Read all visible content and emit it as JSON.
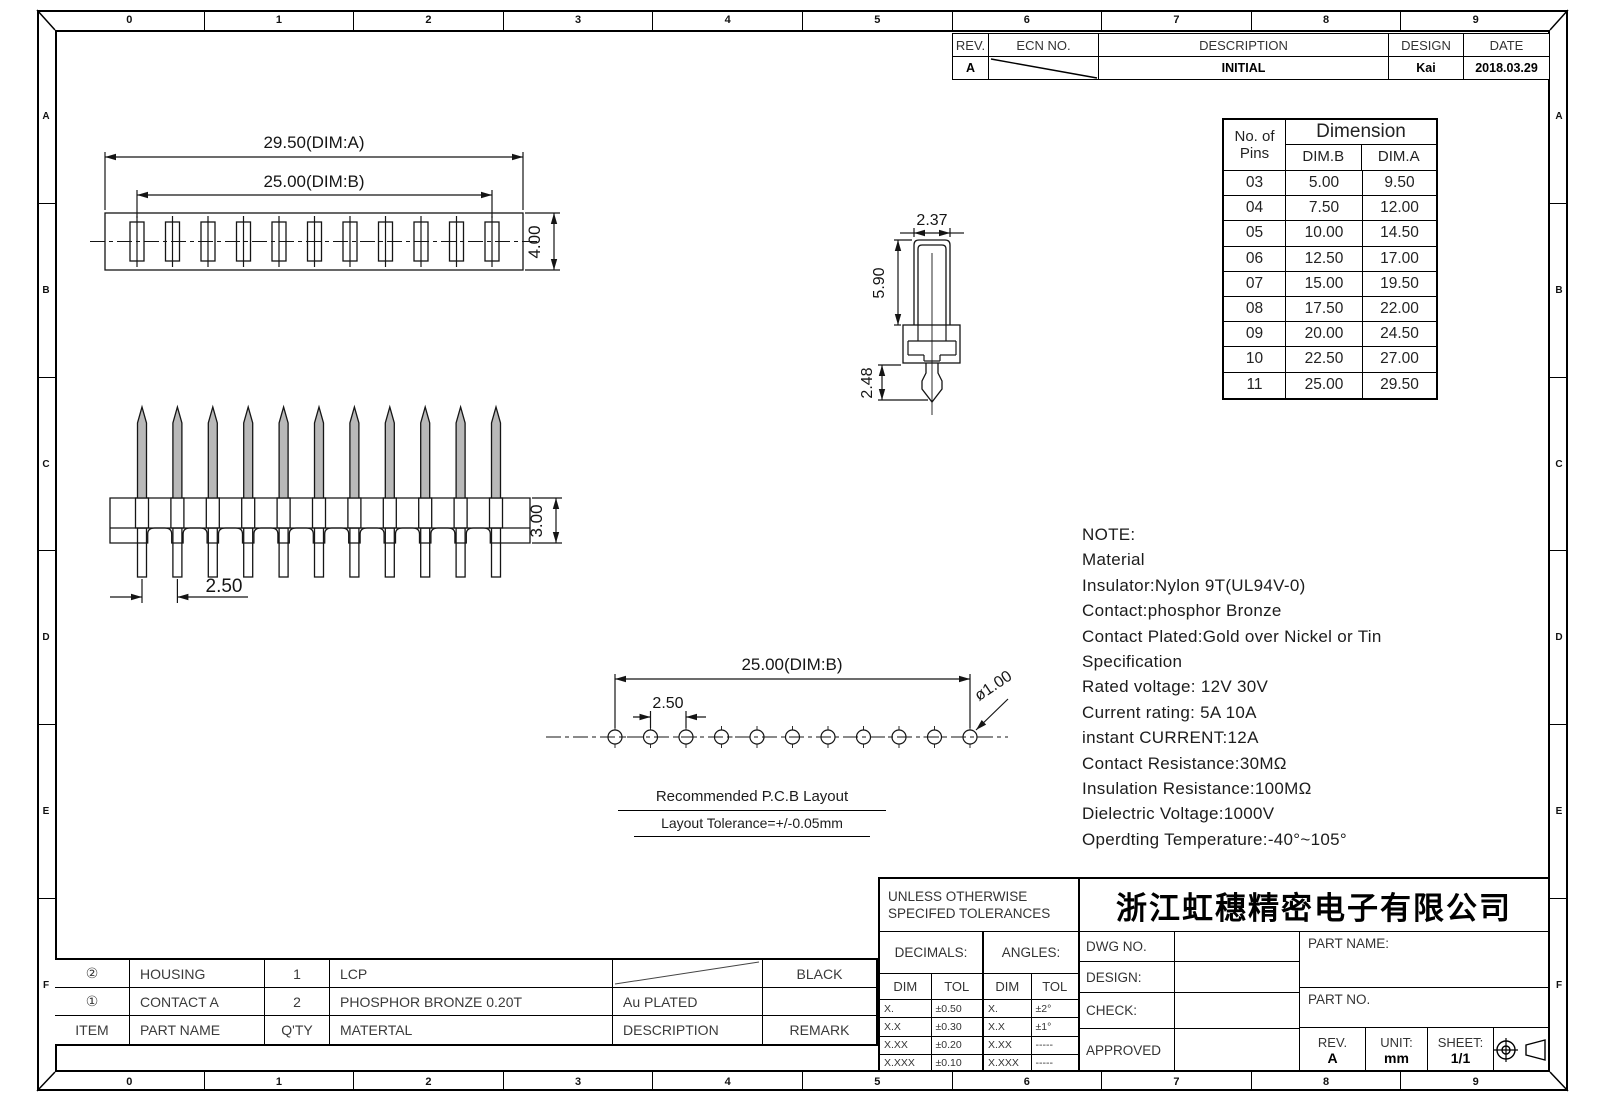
{
  "sheet": {
    "cols": [
      "0",
      "1",
      "2",
      "3",
      "4",
      "5",
      "6",
      "7",
      "8",
      "9"
    ],
    "rows": [
      "A",
      "B",
      "C",
      "D",
      "E",
      "F"
    ]
  },
  "revision_table": {
    "headers": {
      "rev": "REV.",
      "ecn": "ECN  NO.",
      "description": "DESCRIPTION",
      "design": "DESIGN",
      "date": "DATE"
    },
    "rows": [
      {
        "rev": "A",
        "ecn": "",
        "description": "INITIAL",
        "design": "Kai",
        "date": "2018.03.29"
      }
    ]
  },
  "dimension_table": {
    "col1_header_line1": "No.  of",
    "col1_header_line2": "Pins",
    "span_header": "Dimension",
    "dim_b_header": "DIM.B",
    "dim_a_header": "DIM.A",
    "rows": [
      {
        "pins": "03",
        "dim_b": "5.00",
        "dim_a": "9.50"
      },
      {
        "pins": "04",
        "dim_b": "7.50",
        "dim_a": "12.00"
      },
      {
        "pins": "05",
        "dim_b": "10.00",
        "dim_a": "14.50"
      },
      {
        "pins": "06",
        "dim_b": "12.50",
        "dim_a": "17.00"
      },
      {
        "pins": "07",
        "dim_b": "15.00",
        "dim_a": "19.50"
      },
      {
        "pins": "08",
        "dim_b": "17.50",
        "dim_a": "22.00"
      },
      {
        "pins": "09",
        "dim_b": "20.00",
        "dim_a": "24.50"
      },
      {
        "pins": "10",
        "dim_b": "22.50",
        "dim_a": "27.00"
      },
      {
        "pins": "11",
        "dim_b": "25.00",
        "dim_a": "29.50"
      }
    ]
  },
  "views": {
    "top_view": {
      "pin_count": 11,
      "dim_a": "29.50(DIM:A)",
      "dim_b": "25.00(DIM:B)",
      "height": "4.00"
    },
    "front_view": {
      "pin_count": 11,
      "pitch": "2.50",
      "height": "3.00"
    },
    "contact_view": {
      "width": "2.37",
      "height": "5.90",
      "tail": "2.48"
    },
    "pcb_layout": {
      "hole_count": 11,
      "dim_b": "25.00(DIM:B)",
      "pitch": "2.50",
      "hole_dia": "ø1.00",
      "caption_title": "Recommended  P.C.B  Layout",
      "caption_tolerance": "Layout  Tolerance=+/-0.05mm"
    }
  },
  "notes": {
    "lines": [
      "NOTE:",
      "Material",
      "Insulator:Nylon  9T(UL94V-0)",
      "Contact:phosphor  Bronze",
      "Contact  Plated:Gold  over  Nickel  or  Tin",
      "Specification",
      "Rated  voltage:  12V  30V",
      "Current  rating:   5A  10A",
      "instant  CURRENT:12A",
      "Contact  Resistance:30MΩ",
      "Insulation  Resistance:100MΩ",
      "Dielectric  Voltage:1000V",
      "Operdting  Temperature:-40°~105°"
    ]
  },
  "bom_table": {
    "headers": {
      "item": "ITEM",
      "part_name": "PART  NAME",
      "qty": "Q'TY",
      "material": "MATERTAL",
      "description": "DESCRIPTION",
      "remark": "REMARK"
    },
    "rows": [
      {
        "item": "②",
        "part_name": "HOUSING",
        "qty": "1",
        "material": "LCP",
        "description": "",
        "remark": "BLACK"
      },
      {
        "item": "①",
        "part_name": "CONTACT  A",
        "qty": "2",
        "material": "PHOSPHOR  BRONZE  0.20T",
        "description": "Au  PLATED",
        "remark": ""
      }
    ]
  },
  "tolerance_block": {
    "title_line1": "UNLESS  OTHERWISE",
    "title_line2": "SPECIFED  TOLERANCES",
    "decimals_label": "DECIMALS:",
    "angles_label": "ANGLES:",
    "dim_header": "DIM",
    "tol_header": "TOL",
    "decimals": [
      [
        "X.",
        "±0.50"
      ],
      [
        "X.X",
        "±0.30"
      ],
      [
        "X.XX",
        "±0.20"
      ],
      [
        "X.XXX",
        "±0.10"
      ]
    ],
    "angles": [
      [
        "X.",
        "±2°"
      ],
      [
        "X.X",
        "±1°"
      ],
      [
        "X.XX",
        "-----"
      ],
      [
        "X.XXX",
        "-----"
      ]
    ]
  },
  "title_block": {
    "company": "浙江虹穗精密电子有限公司",
    "dwg_no_label": "DWG  NO.",
    "design_label": "DESIGN:",
    "check_label": "CHECK:",
    "approved_label": "APPROVED",
    "part_name_label": "PART  NAME:",
    "part_no_label": "PART  NO.",
    "rev_label": "REV.",
    "rev_value": "A",
    "unit_label": "UNIT:",
    "unit_value": "mm",
    "sheet_label": "SHEET:",
    "sheet_value": "1/1"
  }
}
